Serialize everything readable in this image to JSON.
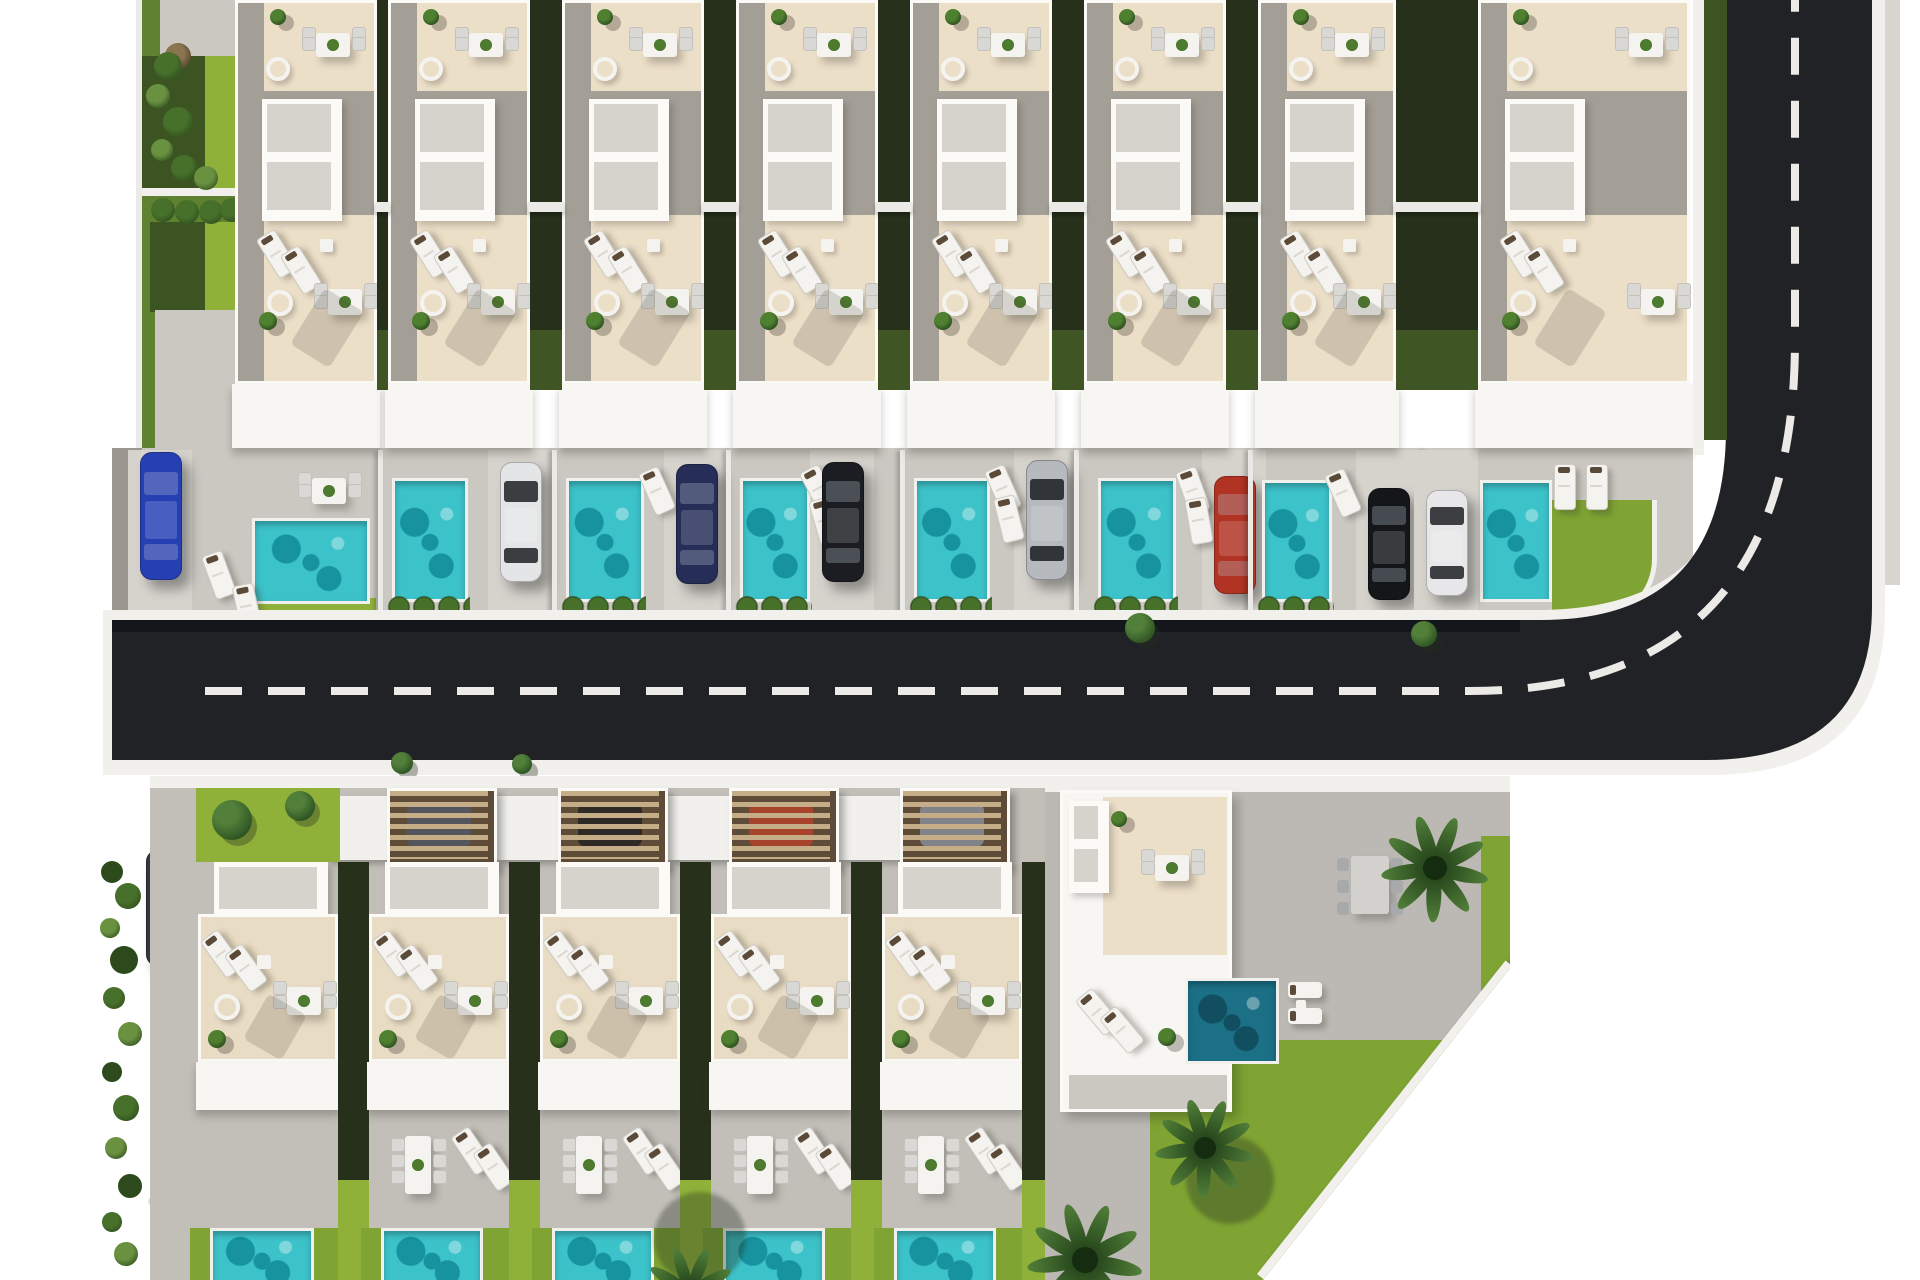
{
  "scene": {
    "description": "Top-down 3D architectural render of a villa development site plan: a top row of eight white villas with beige roof terraces, stippled skylights, turquoise plunge pools and parked cars; an L-shaped dark asphalt road with a white dashed centerline curving up the right side; a bottom row of five villas with wooden carport pergolas, patios and pools; a larger corner villa with palm trees, dark teal pool and lawns cut by a diagonal site boundary; greenery strips, hedges and bushes on white background margins.",
    "canvas": {
      "width": 1920,
      "height": 1280,
      "background": "#ffffff"
    },
    "palette": {
      "road": "#202226",
      "road_shadow": "#101215",
      "dash": "#eceae6",
      "curb": "#f1f0ec",
      "sidewalk_gray": "#d8d6d1",
      "yard": "#cbc8c2",
      "yard_light": "#d6d3cd",
      "yard_edge": "#9b978f",
      "patio": "#c2bfb9",
      "patio_big": "#bcb9b4",
      "villa_white": "#f7f6f3",
      "frame_white": "#fbfaf7",
      "facade_shadow": "rgba(60,55,48,0.30)",
      "beige": "#ecdfc8",
      "beige2": "#e9dcc4",
      "concrete": "#a39e96",
      "concrete_dark": "#8f8b84",
      "skylight": "#d6d3cd",
      "pool": "#3cc2c9",
      "pool_dark": "#17939f",
      "pool_light": "#8ce4e4",
      "pool_deep": "#1b7086",
      "pool_deep_dark": "#114f60",
      "lawn": "#7fa433",
      "lawn_bright": "#8fb13a",
      "lawn_dark": "#5f8230",
      "hedge": "#26301a",
      "hedge_lite": "#3c5422",
      "bush_dark": "#2c4a1b",
      "bush_mid": "#47702a",
      "bush_lite": "#699140",
      "tree_dark": "#2f5423",
      "tree_lite": "#52803a",
      "pergola_slat": "#c5ad87",
      "pergola_gap": "#5f4c38",
      "table_white": "#f4f3ef",
      "chair_gray": "#d9d8d4",
      "headrest": "#5c4a38",
      "shadow": "rgba(60,55,48,0.28)"
    },
    "car_colors": {
      "blue": "#2640b4",
      "white": "#e4e5e7",
      "navy": "#262e58",
      "black": "#1c1d22",
      "silver": "#b6b9bd",
      "red": "#b03323",
      "black2": "#15161a",
      "white2": "#e7e7e9",
      "suv": "#33363c",
      "gray": "#53565c",
      "darkbrown": "#2e2a25",
      "redcar": "#a8432b",
      "lightgray": "#808489"
    },
    "road": {
      "asphalt_path": "M 112,620 H 1542 Q 1726,620 1726,428 V -20 H 1872 V 606 Q 1872,760 1706,760 H 112 Z",
      "curb_path": "M 103,610 H 1536 Q 1736,610 1736,424 V -20 H 1885 V 608 Q 1885,775 1710,775 H 103 Z",
      "dash_path": "M 205,691 H 1470 Q 1795,691 1795,340 V -10",
      "dash_length": 37,
      "dash_gap": 26,
      "dash_width": 8,
      "top_shadow": {
        "x": 112,
        "y": 620,
        "w": 1408,
        "h": 12
      },
      "green_strip": {
        "x": 1704,
        "y": 0,
        "w": 23,
        "h": 440
      },
      "white_wall": {
        "x": 1693,
        "y": 0,
        "w": 11,
        "h": 455
      },
      "gray_walk": {
        "x": 1885,
        "y": 0,
        "w": 15,
        "h": 585
      }
    },
    "top_left_garden": {
      "wall": {
        "x": 136,
        "y": 0,
        "w": 6,
        "h": 448
      },
      "blocks": [
        {
          "x": 142,
          "y": 0,
          "w": 93,
          "h": 448,
          "color": "lawn_dark"
        },
        {
          "x": 160,
          "y": 0,
          "w": 75,
          "h": 56,
          "color": "yard"
        },
        {
          "x": 142,
          "y": 56,
          "w": 70,
          "h": 134,
          "color": "hedge_lite"
        },
        {
          "x": 205,
          "y": 56,
          "w": 30,
          "h": 134,
          "color": "lawn_bright"
        },
        {
          "x": 142,
          "y": 188,
          "w": 93,
          "h": 8,
          "color": "curb"
        },
        {
          "x": 150,
          "y": 222,
          "w": 58,
          "h": 90,
          "color": "hedge_lite"
        },
        {
          "x": 205,
          "y": 222,
          "w": 30,
          "h": 88,
          "color": "lawn_bright"
        },
        {
          "x": 155,
          "y": 310,
          "w": 80,
          "h": 138,
          "color": "yard"
        }
      ],
      "bushes": [
        [
          168,
          66,
          14
        ],
        [
          158,
          96,
          12
        ],
        [
          178,
          122,
          15
        ],
        [
          162,
          150,
          11
        ],
        [
          184,
          168,
          13
        ],
        [
          206,
          178,
          12
        ]
      ],
      "dry_plant": [
        178,
        56,
        13
      ],
      "hedge_balls": [
        [
          163,
          210
        ],
        [
          187,
          212
        ],
        [
          211,
          212
        ],
        [
          232,
          210
        ]
      ]
    },
    "top_row": {
      "yard": {
        "x": 112,
        "y": 448,
        "w": 1581,
        "h": 170
      },
      "facade_y": 384,
      "facade_h": 64,
      "beam_y": 202,
      "lots": [
        {
          "x": 120,
          "w": 258,
          "villa_x": 235,
          "villa_w": 142,
          "pool": [
            252,
            518,
            112,
            80
          ],
          "car": [
            "blue",
            140,
            452,
            126
          ],
          "lawn_strip": [
            246,
            598,
            130,
            20
          ],
          "dining": [
            298,
            464
          ],
          "loungers": [
            [
              208,
              552,
              -20
            ],
            [
              236,
              584,
              -12
            ]
          ]
        },
        {
          "x": 378,
          "w": 174,
          "villa_x": 388,
          "villa_w": 142,
          "pool": [
            392,
            478,
            70,
            118
          ],
          "car": [
            "white",
            500,
            462,
            118
          ],
          "hedge": [
            386,
            594,
            84
          ],
          "loungers": []
        },
        {
          "x": 552,
          "w": 174,
          "villa_x": 562,
          "villa_w": 142,
          "pool": [
            566,
            478,
            72,
            118
          ],
          "car": [
            "navy",
            676,
            464,
            118
          ],
          "hedge": [
            560,
            594,
            86
          ],
          "loungers": [
            [
              646,
              468,
              -24
            ]
          ]
        },
        {
          "x": 726,
          "w": 174,
          "villa_x": 736,
          "villa_w": 142,
          "pool": [
            740,
            478,
            64,
            118
          ],
          "car": [
            "black",
            822,
            462,
            118
          ],
          "hedge": [
            734,
            594,
            78
          ],
          "loungers": [
            [
              808,
              466,
              -28
            ],
            [
              814,
              498,
              -16
            ]
          ]
        },
        {
          "x": 900,
          "w": 174,
          "villa_x": 910,
          "villa_w": 142,
          "pool": [
            914,
            478,
            70,
            118
          ],
          "car": [
            "silver",
            1026,
            460,
            118
          ],
          "hedge": [
            908,
            594,
            84
          ],
          "loungers": [
            [
              992,
              466,
              -24
            ],
            [
              998,
              496,
              -14
            ]
          ]
        },
        {
          "x": 1074,
          "w": 174,
          "villa_x": 1084,
          "villa_w": 142,
          "pool": [
            1098,
            478,
            72,
            118
          ],
          "car": [
            "red",
            1214,
            476,
            116
          ],
          "hedge": [
            1092,
            594,
            86
          ],
          "loungers": [
            [
              1182,
              468,
              -20
            ],
            [
              1188,
              498,
              -10
            ]
          ]
        },
        {
          "x": 1248,
          "w": 174,
          "villa_x": 1258,
          "villa_w": 138,
          "pool": [
            1262,
            480,
            64,
            116
          ],
          "car": [
            "black2",
            1368,
            488,
            110
          ],
          "hedge": [
            1256,
            594,
            78
          ],
          "loungers": [
            [
              1332,
              470,
              -24
            ]
          ]
        },
        {
          "x": 1422,
          "w": 178,
          "villa_x": 1478,
          "villa_w": 212,
          "pool": [
            1480,
            480,
            66,
            116
          ],
          "car": [
            "white2",
            1426,
            490,
            104
          ],
          "lawn_corner": [
            1552,
            500,
            100,
            118
          ],
          "loungers": [
            [
              1554,
              464,
              0
            ],
            [
              1586,
              464,
              0
            ]
          ]
        }
      ]
    },
    "overhang_trees": [
      [
        1140,
        628,
        15
      ],
      [
        1424,
        634,
        13
      ]
    ],
    "sidewalk_trees": [
      [
        402,
        763,
        11
      ],
      [
        522,
        764,
        10
      ]
    ],
    "bottom_left": {
      "bushes": [
        [
          112,
          872,
          11
        ],
        [
          128,
          896,
          13
        ],
        [
          110,
          928,
          10
        ],
        [
          124,
          960,
          14
        ],
        [
          114,
          998,
          11
        ],
        [
          130,
          1034,
          12
        ],
        [
          112,
          1072,
          10
        ],
        [
          126,
          1108,
          13
        ],
        [
          116,
          1148,
          11
        ],
        [
          130,
          1186,
          12
        ],
        [
          112,
          1222,
          10
        ],
        [
          126,
          1254,
          12
        ]
      ],
      "suv": [
        146,
        850,
        38,
        114
      ],
      "patio": {
        "x": 150,
        "y": 776,
        "w": 48,
        "h": 504
      },
      "round_table": [
        210,
        1128,
        28
      ],
      "patio_chairs": [
        [
          186,
          1162,
          -30
        ],
        [
          244,
          1164,
          25
        ]
      ],
      "loungers": [
        [
          158,
          1190,
          -35
        ],
        [
          184,
          1232,
          -35
        ]
      ]
    },
    "bottom_row": {
      "base": {
        "x": 150,
        "y": 776,
        "w": 900,
        "h": 504
      },
      "sidewalk_h": 12,
      "pergola": {
        "y": 788,
        "h": 74
      },
      "entry_blocks": [
        [
          326,
          796,
          70,
          64
        ],
        [
          497,
          796,
          70,
          64
        ],
        [
          668,
          796,
          70,
          64
        ],
        [
          839,
          796,
          70,
          64
        ]
      ],
      "skylight": {
        "y": 862,
        "h": 52
      },
      "roof": {
        "y": 914,
        "h": 148
      },
      "facade": {
        "y": 1062,
        "h": 48
      },
      "patio": {
        "y": 1110,
        "h": 118
      },
      "pool_y": 1228,
      "lots": [
        {
          "x": 190,
          "w": 171,
          "villa_x": 198,
          "villa_w": 140,
          "lawn_top": {
            "x": 196,
            "w": 144,
            "trees": [
              [
                232,
                820,
                20
              ],
              [
                300,
                806,
                15
              ]
            ]
          },
          "pool": [
            210,
            98
          ],
          "furn": "none"
        },
        {
          "x": 361,
          "w": 171,
          "villa_x": 369,
          "villa_w": 140,
          "pergola_car": "gray",
          "pool": [
            381,
            96
          ],
          "furn": "dine6"
        },
        {
          "x": 532,
          "w": 171,
          "villa_x": 540,
          "villa_w": 140,
          "pergola_car": "darkbrown",
          "pool": [
            552,
            96
          ],
          "furn": "dine6"
        },
        {
          "x": 703,
          "w": 171,
          "villa_x": 711,
          "villa_w": 140,
          "pergola_car": "redcar",
          "pool": [
            723,
            96
          ],
          "furn": "dine6"
        },
        {
          "x": 874,
          "w": 171,
          "villa_x": 882,
          "villa_w": 140,
          "pergola_car": "lightgray",
          "pool": [
            894,
            96
          ],
          "furn": "dine6"
        }
      ]
    },
    "big_villa": {
      "origin": [
        1045,
        776
      ],
      "size": [
        465,
        504
      ],
      "clip": "polygon(0px 0px, 465px 0px, 465px 192px, 218px 504px, 0px 504px)",
      "top_wall_h": 16,
      "lawn_blocks": [
        [
          105,
          264,
          360,
          240
        ],
        [
          436,
          60,
          29,
          220
        ]
      ],
      "diag_wall": {
        "left": 212,
        "top": 498,
        "w": 400,
        "h": 9,
        "angle": -51.6
      },
      "villa": {
        "x": 15,
        "y": 14,
        "w": 172,
        "h": 322
      },
      "dining": [
        292,
        66
      ],
      "palm": [
        390,
        92,
        54
      ],
      "pool": [
        140,
        202,
        88,
        80
      ],
      "pool_loungers": [
        [
          243,
          206
        ],
        [
          243,
          232
        ]
      ]
    },
    "palms": [
      [
        1205,
        1148,
        50
      ],
      [
        1085,
        1260,
        58
      ],
      [
        690,
        1292,
        46
      ]
    ],
    "palm_shadows": [
      [
        700,
        1238,
        46
      ],
      [
        1230,
        1180,
        44
      ]
    ]
  }
}
